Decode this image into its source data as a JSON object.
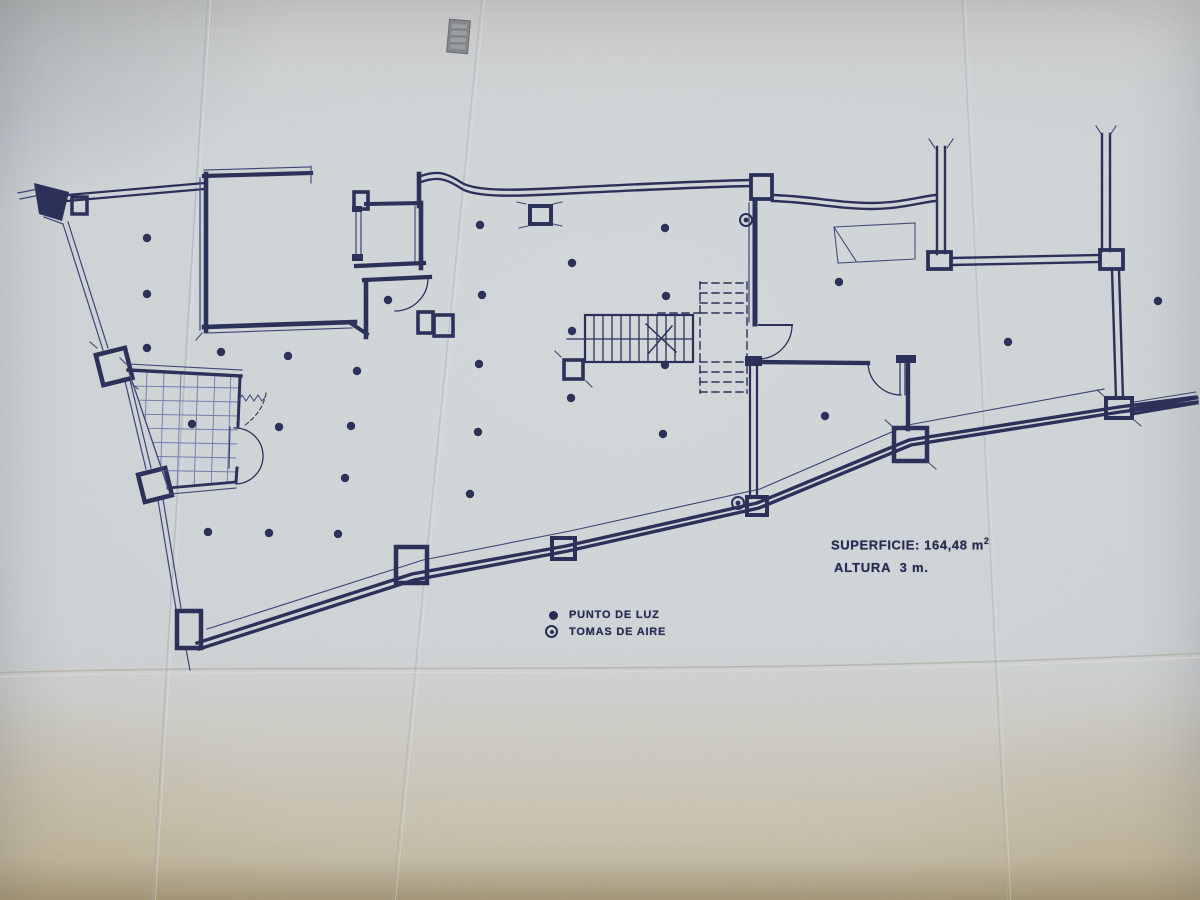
{
  "annotations": {
    "superficie_label": "SUPERFICIE:",
    "superficie_value": " 164,48 m",
    "superficie_exponent": "2",
    "altura": "ALTURA  3 m."
  },
  "legend": {
    "items": [
      {
        "id": "light-point",
        "label": "PUNTO DE LUZ"
      },
      {
        "id": "air-intake",
        "label": "TOMAS DE AIRE"
      }
    ]
  },
  "plan": {
    "ink_color": "#2b3059",
    "thin_ink_color": "#3d4577",
    "light_point_radius": 4.2,
    "light_points": [
      [
        147,
        238
      ],
      [
        147,
        294
      ],
      [
        147,
        348
      ],
      [
        221,
        352
      ],
      [
        288,
        356
      ],
      [
        357,
        371
      ],
      [
        388,
        300
      ],
      [
        480,
        225
      ],
      [
        482,
        295
      ],
      [
        479,
        364
      ],
      [
        478,
        432
      ],
      [
        572,
        263
      ],
      [
        572,
        331
      ],
      [
        571,
        398
      ],
      [
        665,
        228
      ],
      [
        666,
        296
      ],
      [
        665,
        365
      ],
      [
        663,
        434
      ],
      [
        839,
        282
      ],
      [
        825,
        416
      ],
      [
        1008,
        342
      ],
      [
        1158,
        301
      ],
      [
        192,
        424
      ],
      [
        279,
        427
      ],
      [
        351,
        426
      ],
      [
        345,
        478
      ],
      [
        470,
        494
      ],
      [
        208,
        532
      ],
      [
        269,
        533
      ],
      [
        338,
        534
      ]
    ],
    "air_intakes": [
      [
        746,
        220
      ],
      [
        738,
        503
      ]
    ]
  }
}
